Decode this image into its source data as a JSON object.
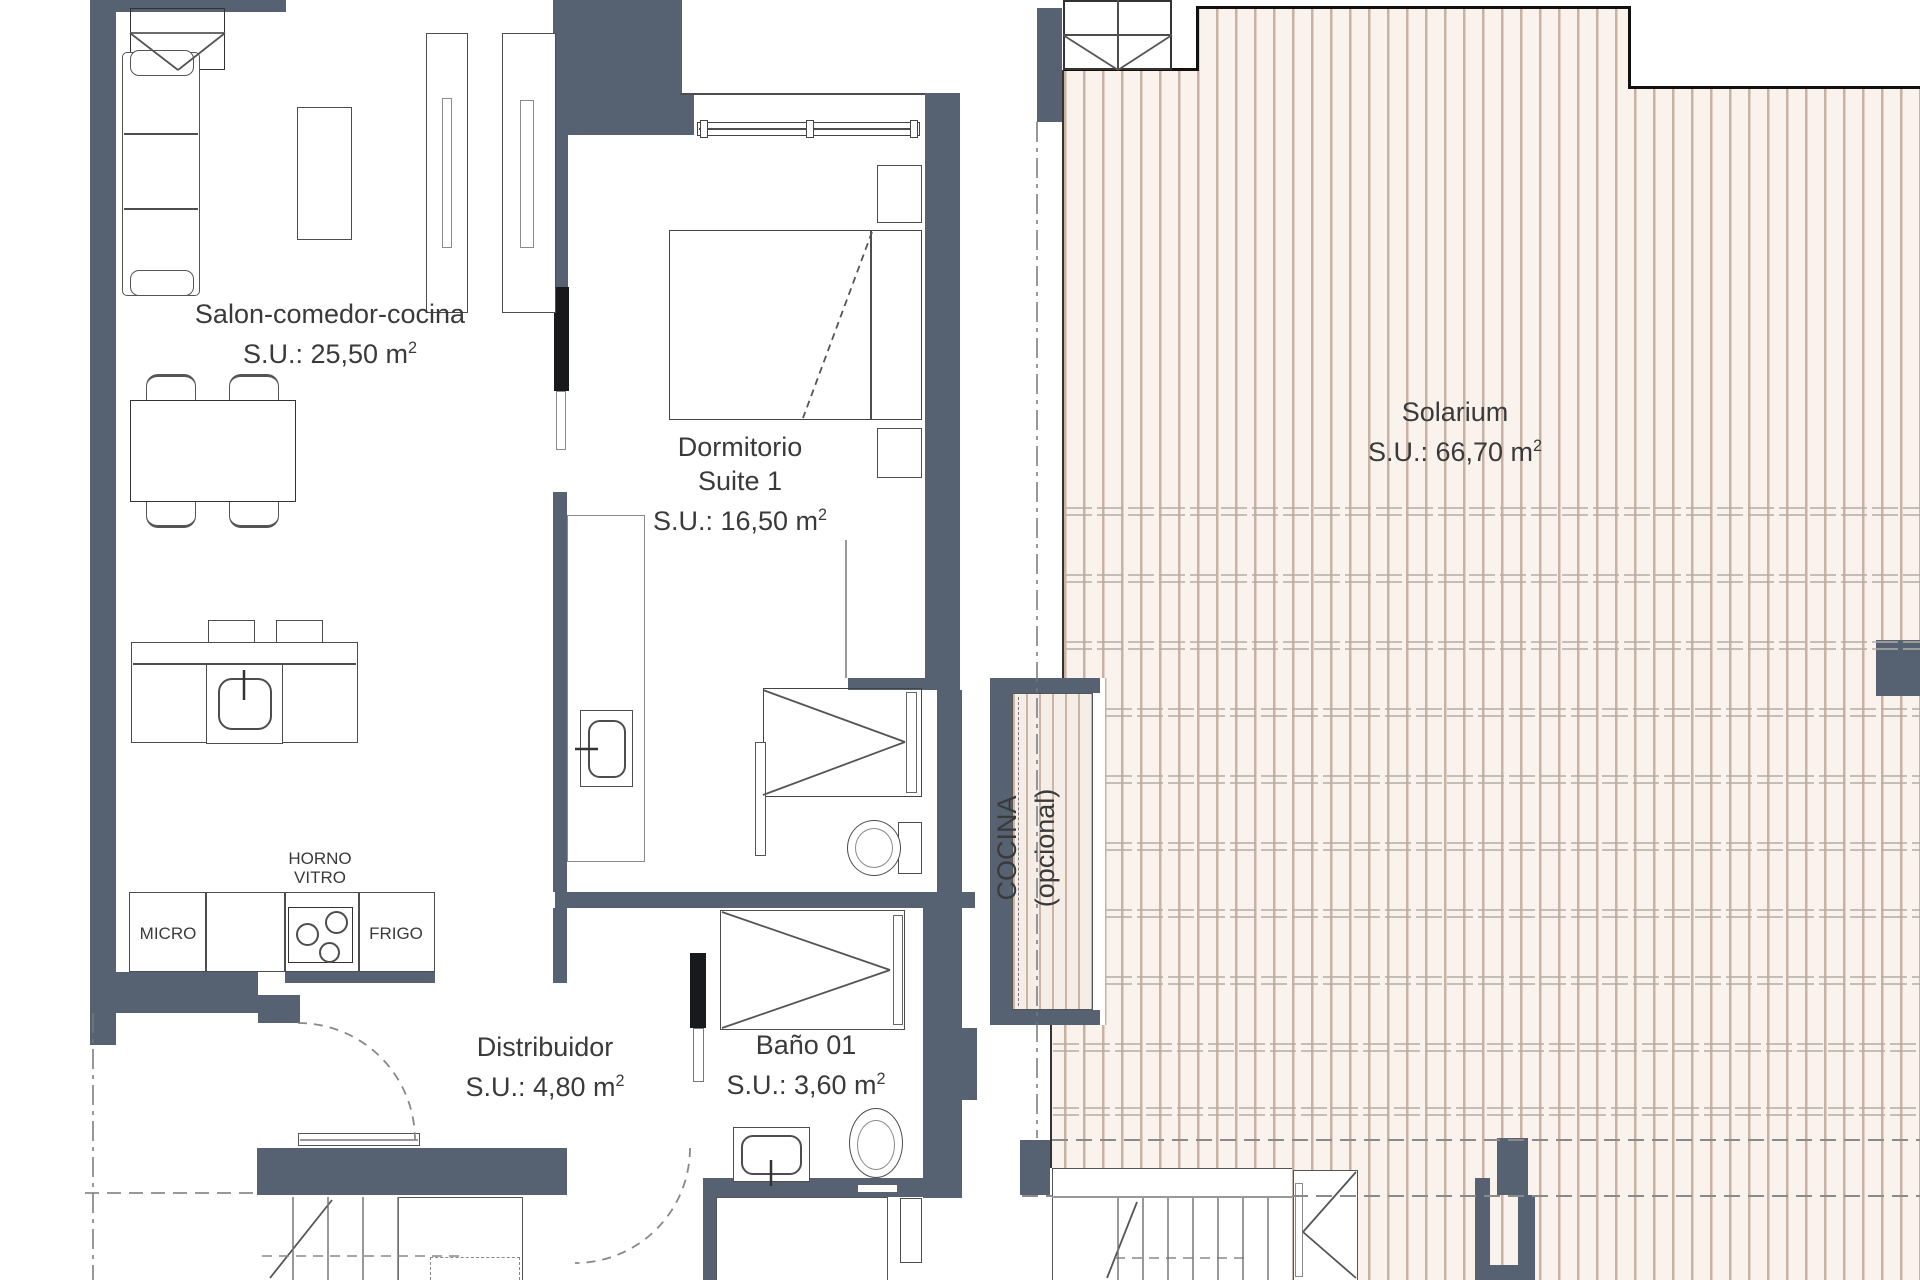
{
  "rooms": {
    "salon": {
      "name": "Salon-comedor-cocina",
      "area": "S.U.: 25,50 m",
      "area_sup": "2"
    },
    "dormitorio": {
      "name": "Dormitorio",
      "name2": "Suite 1",
      "area": "S.U.: 16,50 m",
      "area_sup": "2"
    },
    "distribuidor": {
      "name": "Distribuidor",
      "area": "S.U.: 4,80 m",
      "area_sup": "2"
    },
    "bano": {
      "name": "Baño 01",
      "area": "S.U.: 3,60 m",
      "area_sup": "2"
    },
    "solarium": {
      "name": "Solarium",
      "area": "S.U.: 66,70 m",
      "area_sup": "2"
    },
    "cocina_opcional": {
      "name": "COCINA",
      "name2": "(opcional)"
    }
  },
  "appliances": {
    "micro": "MICRO",
    "frigo": "FRIGO",
    "horno": "HORNO",
    "vitro": "VITRO"
  },
  "colors": {
    "wall": "#566271",
    "wall_dark": "#17191d",
    "hatch_stripe": "#c9b2a2",
    "hatch_bg": "#f9f2ed",
    "line": "#4d4d4d",
    "text": "#3a3a3a"
  }
}
